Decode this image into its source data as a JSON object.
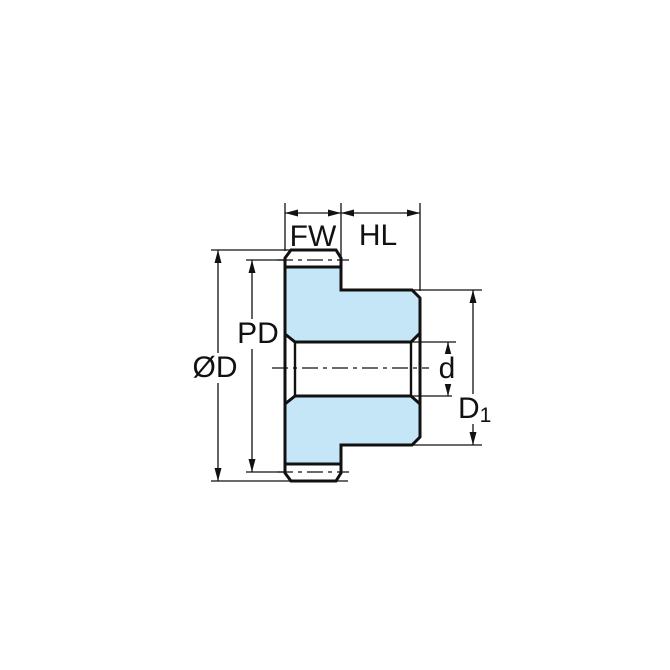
{
  "diagram": {
    "type": "technical-drawing-gear-cross-section",
    "labels": {
      "fw": "FW",
      "hl": "HL",
      "pd": "PD",
      "od": "ØD",
      "d": "d",
      "d1_main": "D",
      "d1_sub": "1"
    },
    "colors": {
      "body_fill": "#c5e6f7",
      "line": "#111111",
      "background": "#ffffff"
    }
  }
}
